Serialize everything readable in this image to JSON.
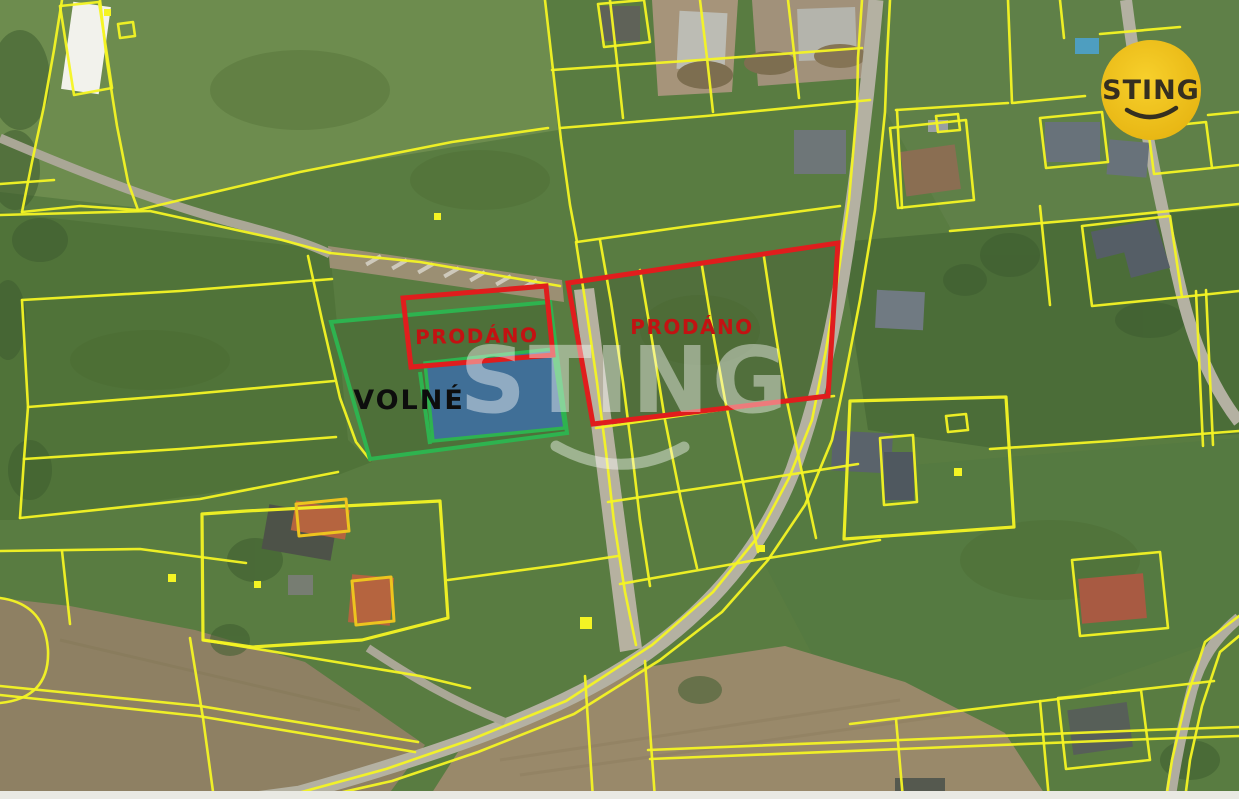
{
  "map": {
    "watermark_text": "STING",
    "logo": {
      "text": "STING",
      "bg_color": "#F0C419",
      "fg_color": "#352F20"
    },
    "labels": {
      "sold_1": "PRODÁNO",
      "sold_2": "PRODÁNO",
      "available": "VOLNÉ"
    },
    "legend_colors": {
      "cadastral_boundary": "#F4F424",
      "sold_outline": "#E01D1D",
      "available_outline": "#2EB34F",
      "reserved_fill": "#3E6EA8"
    },
    "parcels": [
      {
        "name": "parcel-sold-1",
        "status_label": "PRODÁNO",
        "outline_color": "#E01D1D"
      },
      {
        "name": "parcel-sold-2",
        "status_label": "PRODÁNO",
        "outline_color": "#E01D1D"
      },
      {
        "name": "parcel-available",
        "status_label": "VOLNÉ",
        "outline_color": "#2EB34F"
      },
      {
        "name": "parcel-reserved",
        "status_label": "",
        "outline_color": "#2EB34F",
        "fill_color": "#3E6EA8"
      }
    ]
  }
}
